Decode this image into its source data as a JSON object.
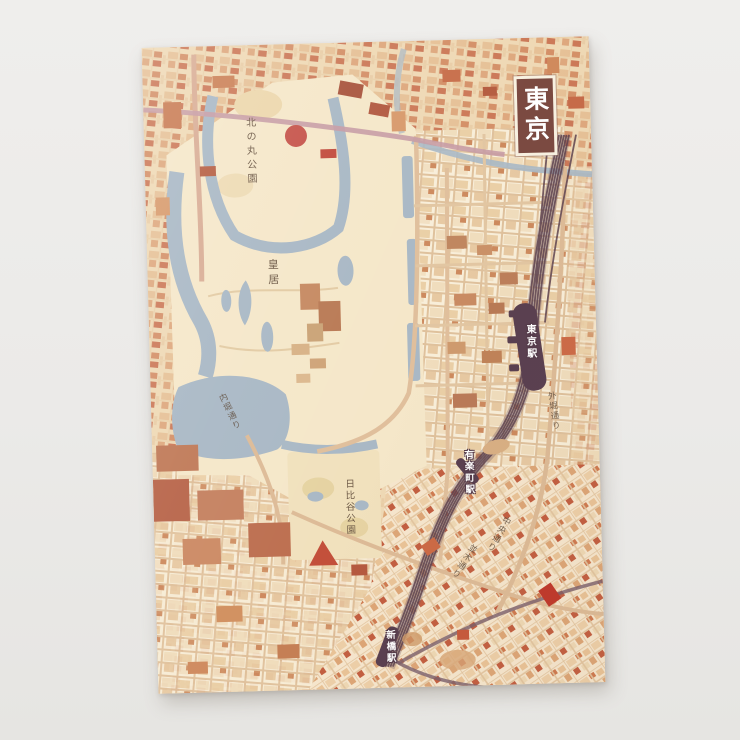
{
  "photo": {
    "description": "Photograph of a printed vintage-style map poster of central Tokyo on a light gray surface",
    "background_color": "#ebeae8"
  },
  "poster": {
    "title_box": {
      "text": "東京",
      "background": "#7b4a41",
      "frame": "#f8f1e1",
      "text_color": "#ffffff"
    },
    "map_labels": {
      "kitanomaru_park": "北の丸公園",
      "imperial_palace": "皇居",
      "tokyo_station": "東京駅",
      "yurakucho_station": "有楽町駅",
      "hibiya_park": "日比谷公園",
      "shimbashi_station": "新橋駅",
      "uchibori_dori": "内堀通り",
      "sotobori_dori": "外堀通り",
      "chuo_dori": "中央通り",
      "namiki_dori": "並木通り"
    },
    "palette": {
      "paper": "#f2dfc2",
      "palace_ground": "#f5e7c9",
      "water": "#a9b8c5",
      "railway": "#5e4350",
      "landmark_red": "#c6544b",
      "building_orange": "#cd7c52",
      "road_tan": "#ddbb97",
      "expressway_mauve": "#c79ba4"
    }
  }
}
